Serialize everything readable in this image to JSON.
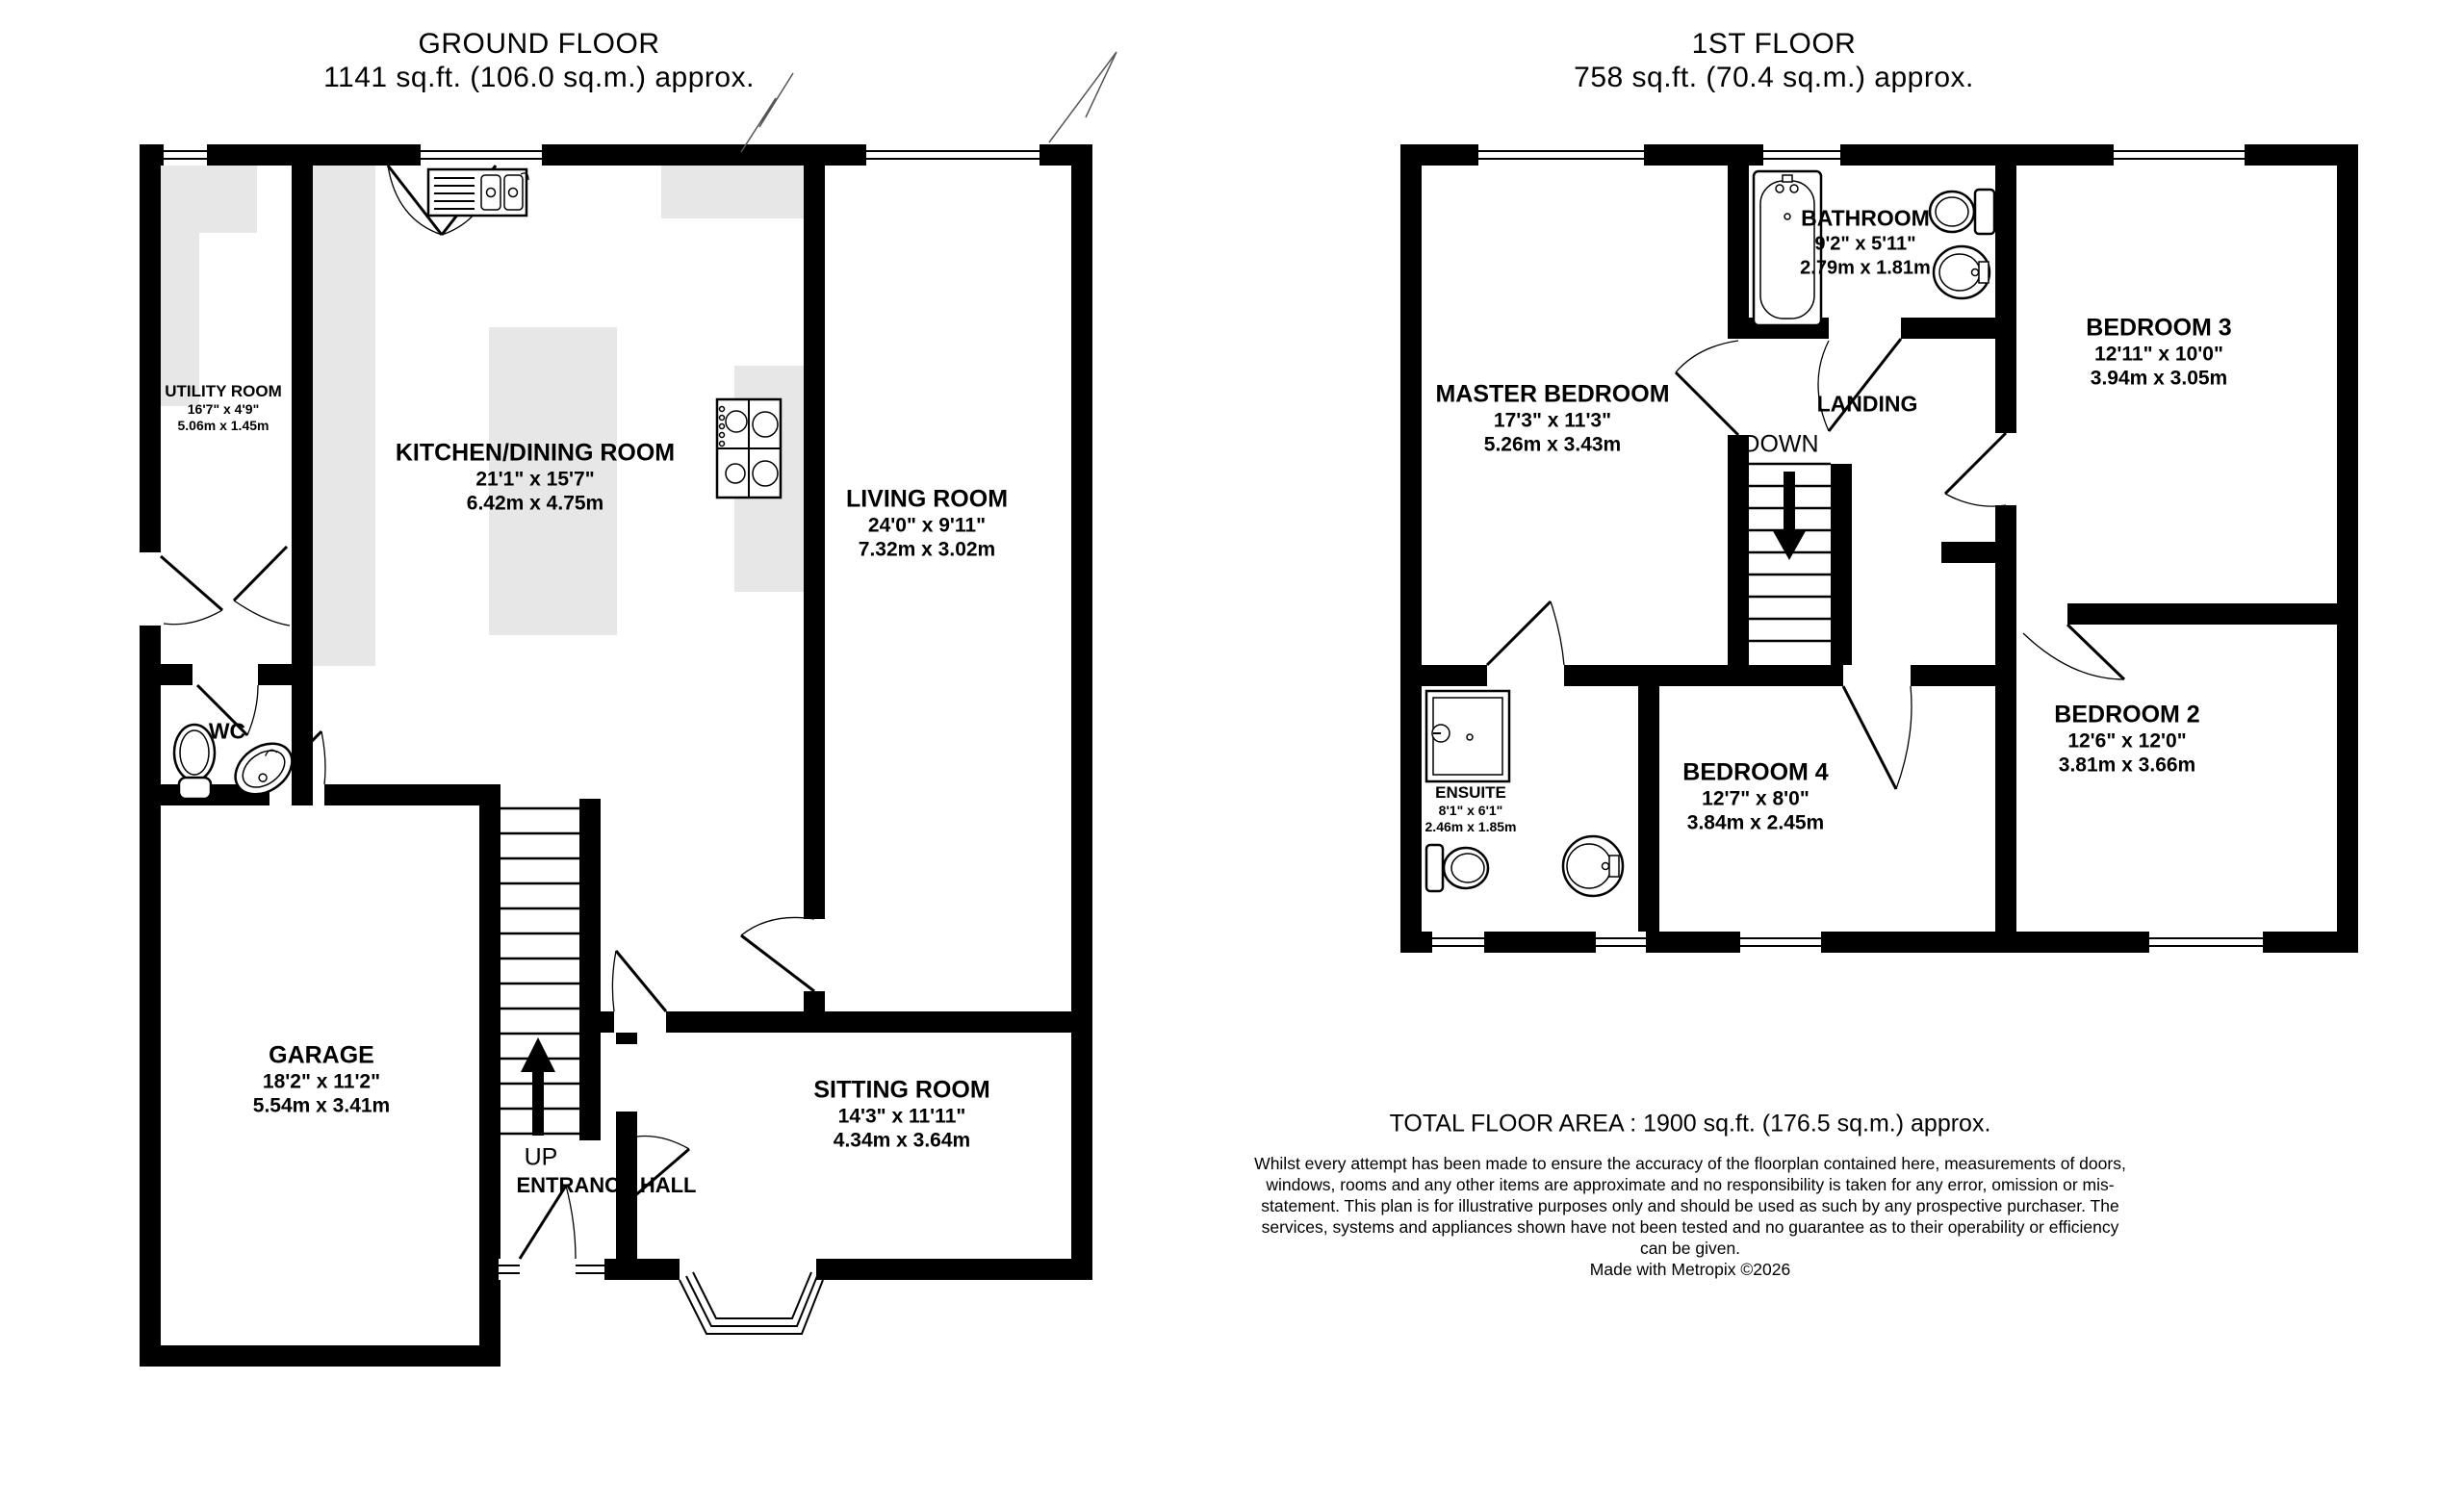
{
  "ground_floor": {
    "title": "GROUND FLOOR",
    "subtitle": "1141 sq.ft. (106.0 sq.m.) approx.",
    "rooms": {
      "utility": {
        "name": "UTILITY ROOM",
        "imperial": "16'7\"  x 4'9\"",
        "metric": "5.06m  x 1.45m"
      },
      "kitchen": {
        "name": "KITCHEN/DINING ROOM",
        "imperial": "21'1\"  x 15'7\"",
        "metric": "6.42m  x 4.75m"
      },
      "living": {
        "name": "LIVING ROOM",
        "imperial": "24'0\"  x 9'11\"",
        "metric": "7.32m  x 3.02m"
      },
      "wc": {
        "name": "WC"
      },
      "garage": {
        "name": "GARAGE",
        "imperial": "18'2\"  x 11'2\"",
        "metric": "5.54m  x 3.41m"
      },
      "sitting": {
        "name": "SITTING ROOM",
        "imperial": "14'3\"  x 11'11\"",
        "metric": "4.34m  x 3.64m"
      },
      "entrance": {
        "name": "ENTRANCE HALL"
      }
    },
    "labels": {
      "up": "UP"
    }
  },
  "first_floor": {
    "title": "1ST FLOOR",
    "subtitle": "758 sq.ft. (70.4 sq.m.) approx.",
    "rooms": {
      "master": {
        "name": "MASTER BEDROOM",
        "imperial": "17'3\"  x 11'3\"",
        "metric": "5.26m  x 3.43m"
      },
      "bathroom": {
        "name": "BATHROOM",
        "imperial": "9'2\"  x 5'11\"",
        "metric": "2.79m  x 1.81m"
      },
      "bedroom3": {
        "name": "BEDROOM 3",
        "imperial": "12'11\"  x 10'0\"",
        "metric": "3.94m  x 3.05m"
      },
      "landing": {
        "name": "LANDING"
      },
      "ensuite": {
        "name": "ENSUITE",
        "imperial": "8'1\"  x 6'1\"",
        "metric": "2.46m  x 1.85m"
      },
      "bedroom4": {
        "name": "BEDROOM 4",
        "imperial": "12'7\"  x 8'0\"",
        "metric": "3.84m  x 2.45m"
      },
      "bedroom2": {
        "name": "BEDROOM 2",
        "imperial": "12'6\"  x 12'0\"",
        "metric": "3.81m  x 3.66m"
      }
    },
    "labels": {
      "down": "DOWN"
    }
  },
  "footer": {
    "total_area": "TOTAL FLOOR AREA : 1900 sq.ft. (176.5 sq.m.) approx.",
    "disclaimer": "Whilst every attempt has been made to ensure the accuracy of the floorplan contained here, measurements of doors, windows, rooms and any other items are approximate and no responsibility is taken for any error, omission or mis-statement. This plan is for illustrative purposes only and should be used as such by any prospective purchaser. The services, systems and appliances shown have not been tested and no guarantee as to their operability or efficiency can be given.",
    "credit": "Made with Metropix ©2026"
  },
  "colors": {
    "wall": "#000000",
    "counter": "#e7e7e7",
    "background": "#ffffff"
  }
}
